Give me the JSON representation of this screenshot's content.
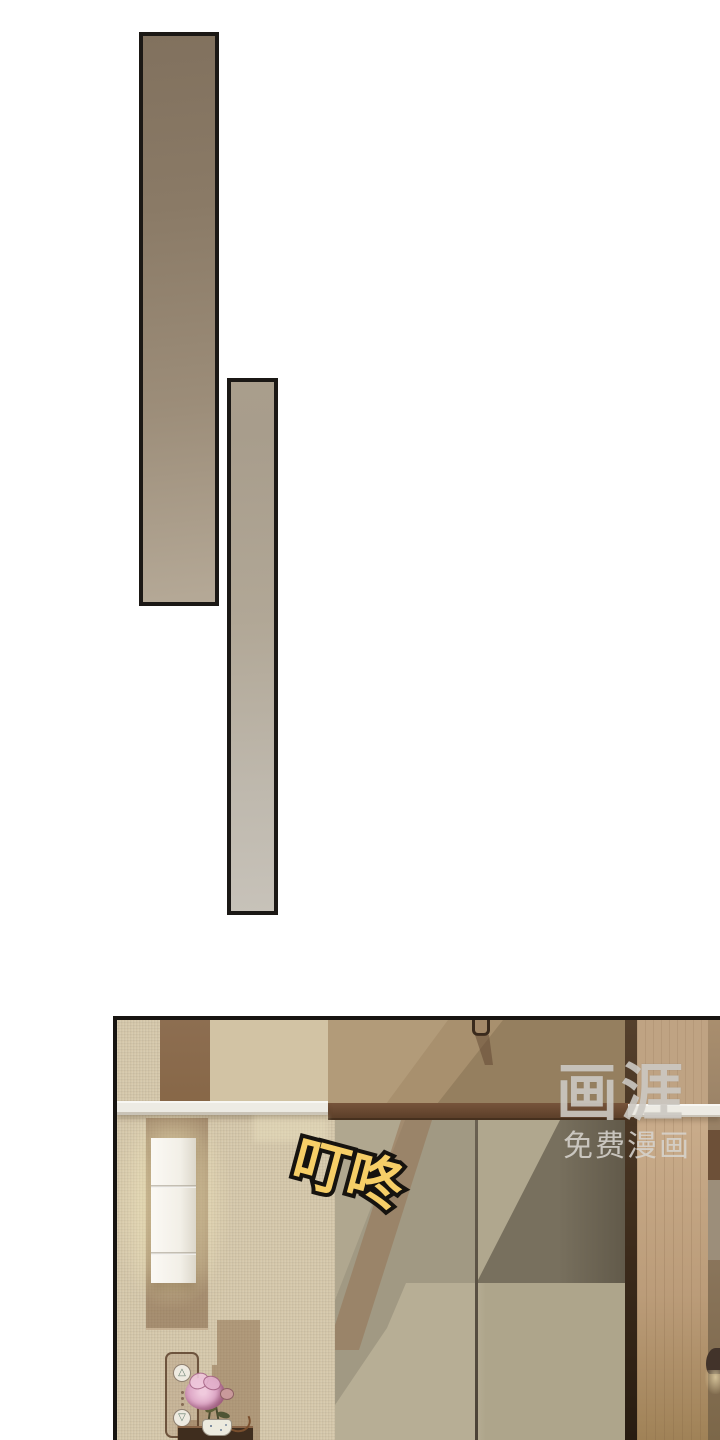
{
  "artwork": {
    "sfx": {
      "char1": "叮",
      "char2": "咚",
      "fill_color": "#f6ce67",
      "outline_color": "#16130f"
    },
    "watermark": {
      "logo": "画涯",
      "tagline": "免费漫画",
      "color": "#d1cec8"
    },
    "elevator_panel": {
      "up_glyph": "△",
      "down_glyph": "▽"
    },
    "palette": {
      "page_background": "#ffffff",
      "panel_border": "#171411",
      "strip1_top": "#81715e",
      "strip1_bottom": "#b5a997",
      "strip2_top": "#a89d8c",
      "strip2_bottom": "#c7c2b9",
      "wall_beige": "#d5c7aa",
      "wall_stripe_brown": "#8a6a4d",
      "wall_center_tan": "#a8906e",
      "door_frame_brown": "#5c3f29",
      "door_glass": "#a19983",
      "rail_white": "#edebe4",
      "lamp_white": "#f2efe7",
      "right_wood": "#bfa383"
    }
  }
}
